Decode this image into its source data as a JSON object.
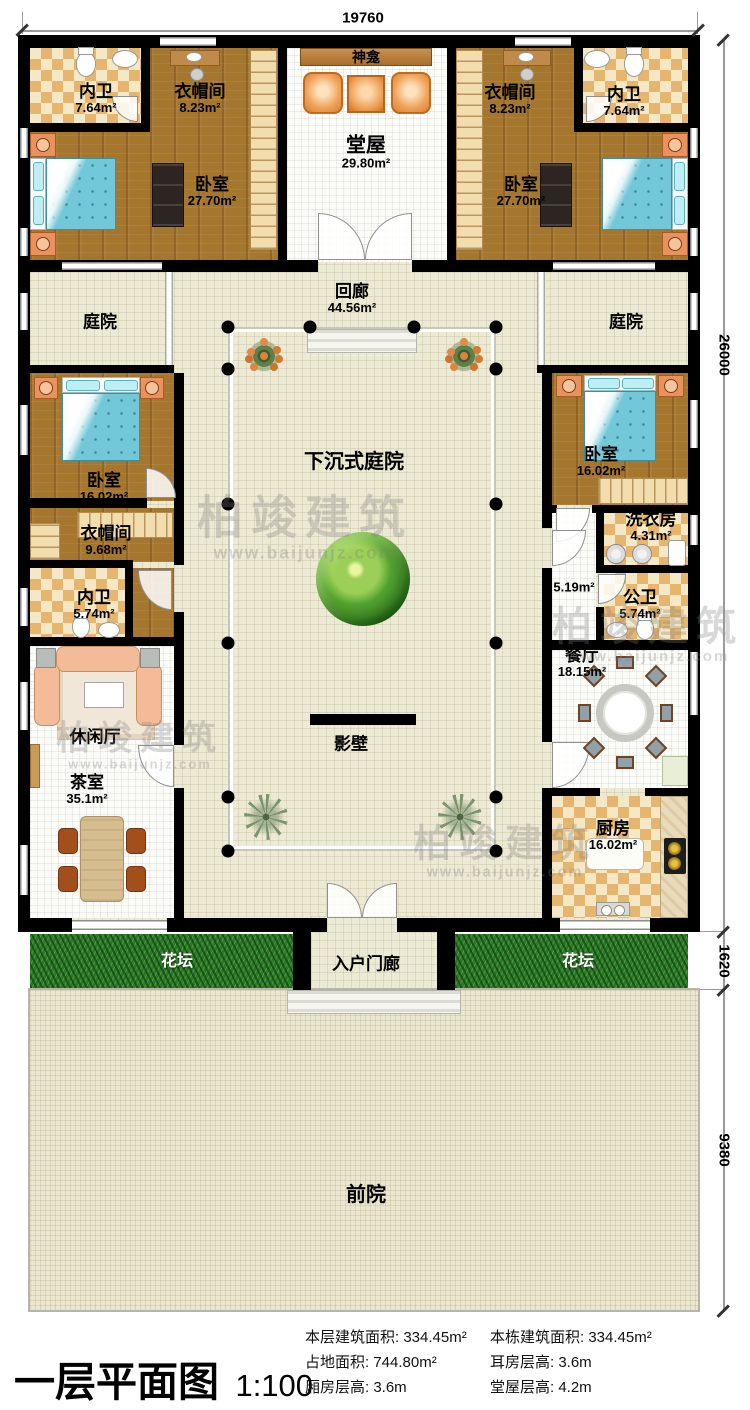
{
  "dimensions": {
    "top": "19760",
    "right_upper": "26000",
    "right_mid": "1620",
    "right_lower": "9380"
  },
  "rooms": {
    "neiwei_tl": {
      "name": "内卫",
      "area": "7.64m²"
    },
    "yimaojian_tl": {
      "name": "衣帽间",
      "area": "8.23m²"
    },
    "shenkan": {
      "name": "神龛"
    },
    "tangwu": {
      "name": "堂屋",
      "area": "29.80m²"
    },
    "yimaojian_tr": {
      "name": "衣帽间",
      "area": "8.23m²"
    },
    "neiwei_tr": {
      "name": "内卫",
      "area": "7.64m²"
    },
    "woshi_tl": {
      "name": "卧室",
      "area": "27.70m²"
    },
    "woshi_tr": {
      "name": "卧室",
      "area": "27.70m²"
    },
    "tingyuan_l": {
      "name": "庭院"
    },
    "huilang": {
      "name": "回廊",
      "area": "44.56m²"
    },
    "tingyuan_r": {
      "name": "庭院"
    },
    "woshi_ml": {
      "name": "卧室",
      "area": "16.02m²"
    },
    "woshi_mr": {
      "name": "卧室",
      "area": "16.02m²"
    },
    "sunken": {
      "name": "下沉式庭院"
    },
    "yimaojian_ml": {
      "name": "衣帽间",
      "area": "9.68m²"
    },
    "xiyifang": {
      "name": "洗衣房",
      "area": "4.31m²"
    },
    "neiwei_ml": {
      "name": "内卫",
      "area": "5.74m²"
    },
    "hall": {
      "area": "5.19m²"
    },
    "gongwei": {
      "name": "公卫",
      "area": "5.74m²"
    },
    "canting": {
      "name": "餐厅",
      "area": "18.15m²"
    },
    "xiuxianting": {
      "name": "休闲厅"
    },
    "yingbi": {
      "name": "影壁"
    },
    "chashi": {
      "name": "茶室",
      "area": "35.1m²"
    },
    "chufang": {
      "name": "厨房",
      "area": "16.02m²"
    },
    "huatan_l": {
      "name": "花坛"
    },
    "menglang": {
      "name": "入户门廊"
    },
    "huatan_r": {
      "name": "花坛"
    },
    "qianyuan": {
      "name": "前院"
    }
  },
  "legend": {
    "title": "一层平面图",
    "scale": "1:100",
    "stats_col1": [
      "本层建筑面积: 334.45m²",
      "占地面积: 744.80m²",
      "厢房层高: 3.6m"
    ],
    "stats_col2": [
      "本栋建筑面积: 334.45m²",
      "耳房层高: 3.6m",
      "堂屋层高: 4.2m"
    ]
  },
  "watermark": {
    "brand": "柏竣建筑",
    "url": "www.baijunjz.com"
  }
}
